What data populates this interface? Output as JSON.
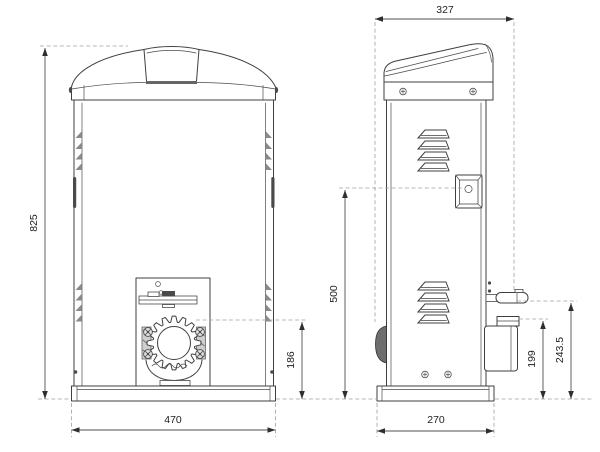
{
  "drawing": {
    "type": "technical-dimension-drawing",
    "subject": "sliding-gate-operator",
    "views": {
      "front": {
        "dims": {
          "overall_height": "825",
          "base_width": "470",
          "pinion_height": "186"
        }
      },
      "side": {
        "dims": {
          "overall_depth": "327",
          "lock_height": "500",
          "pinion_top_height": "199",
          "release_lever_height": "243.5",
          "base_depth": "270"
        }
      }
    },
    "colors": {
      "background": "#ffffff",
      "outline": "#3f3f3f",
      "dimension": "#4f4f4f",
      "dashed_reference": "#a0a0a0",
      "label_text": "#222222"
    }
  }
}
